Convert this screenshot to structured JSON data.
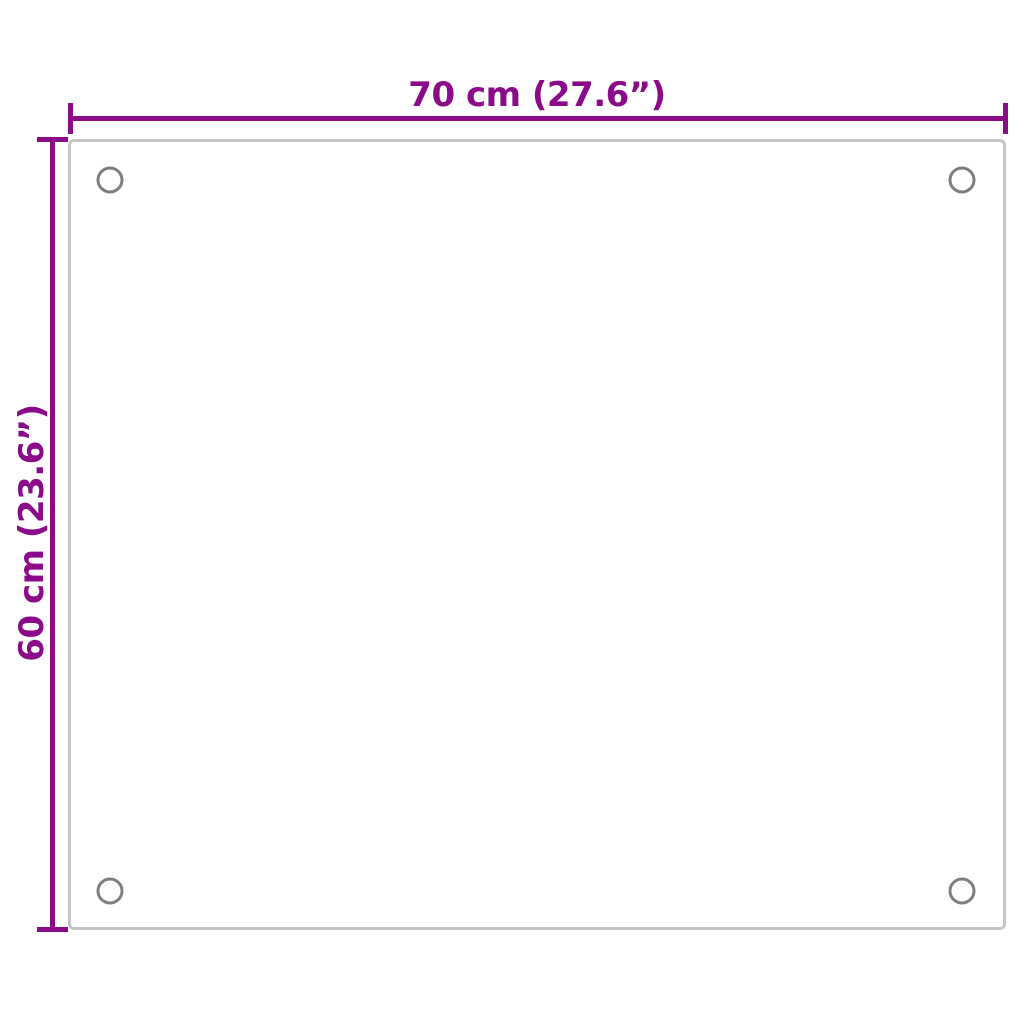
{
  "figure": {
    "type": "product-dimension-diagram",
    "subject": "rectangular glass panel with four corner mounting holes",
    "width_label": "70 cm (27.6”)",
    "height_label": "60 cm (23.6”)"
  },
  "colors": {
    "dimension": "#8a0a8a",
    "panel_border": "#c5c5c5",
    "hole": "#7e7e7e",
    "background": "#ffffff"
  }
}
